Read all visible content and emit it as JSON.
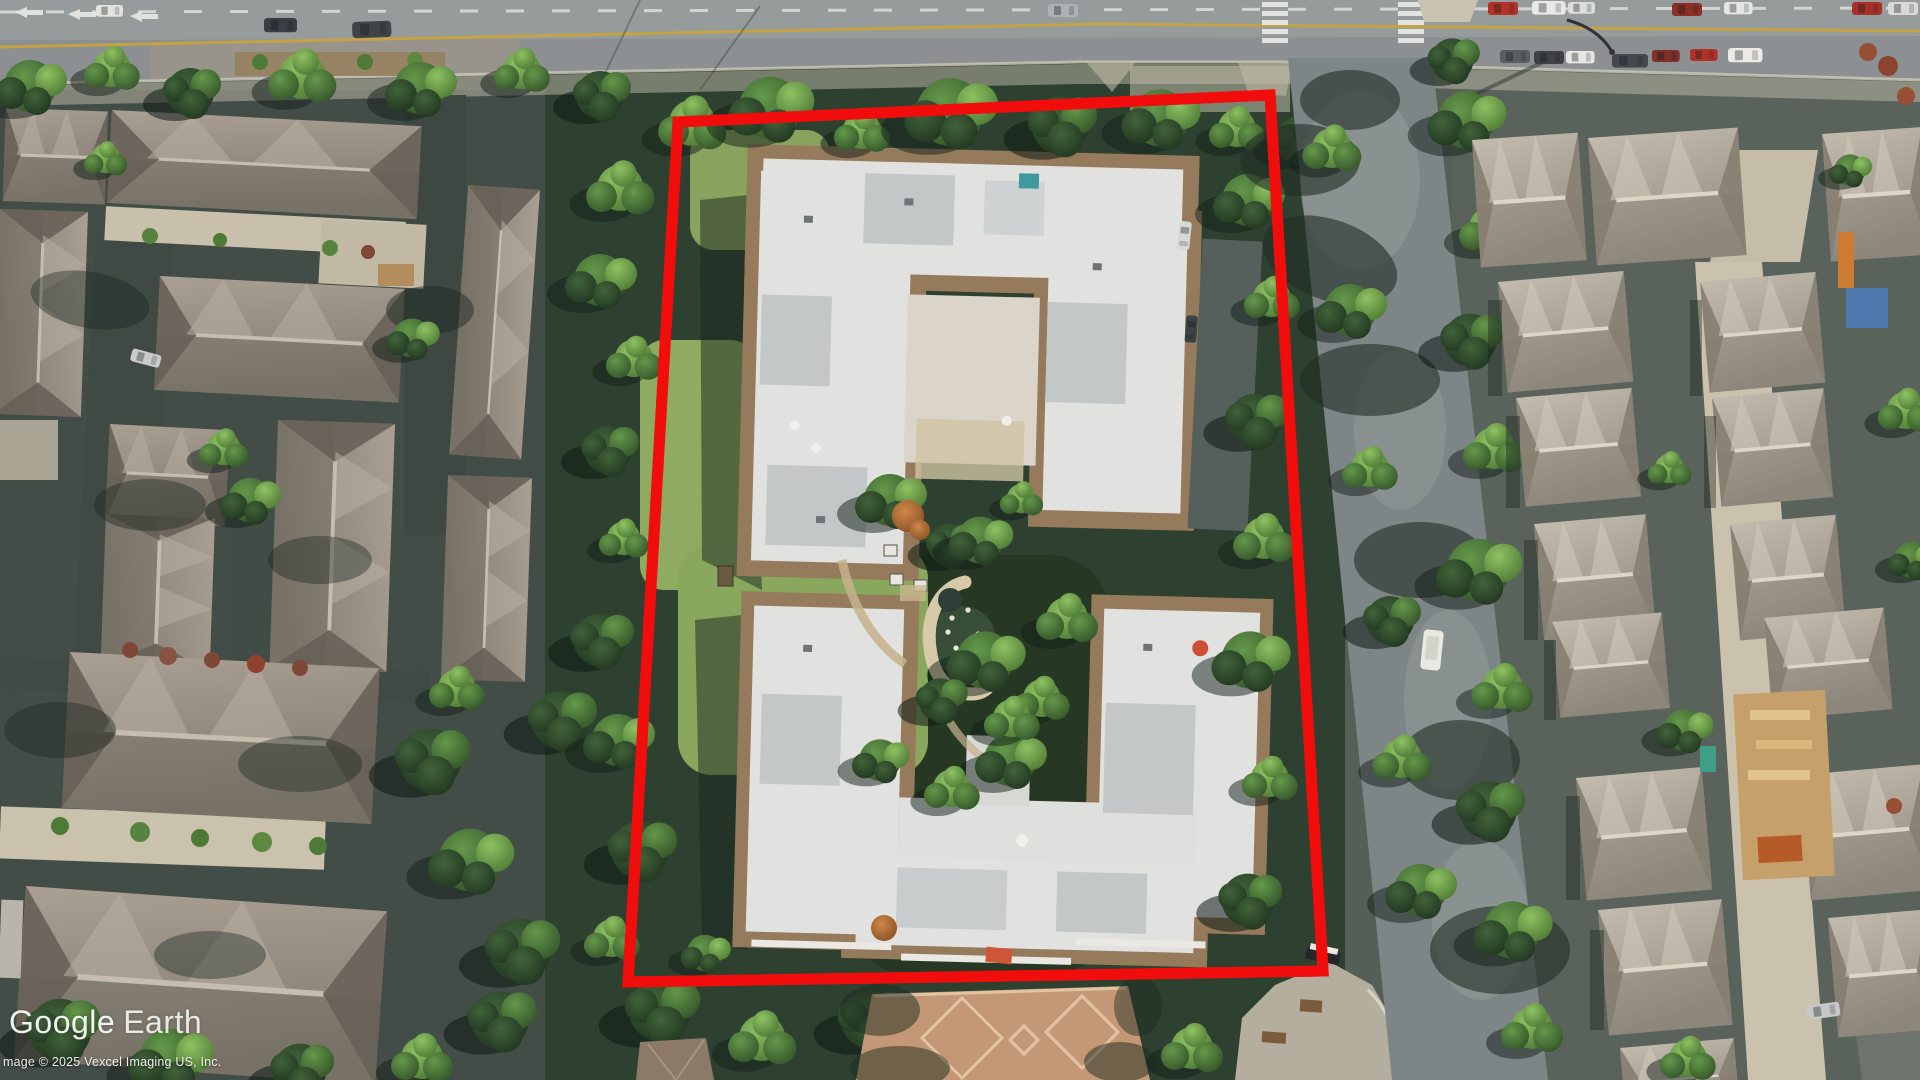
{
  "app": {
    "name_visible_in_watermark": "Google Earth"
  },
  "watermark": {
    "google": "Google",
    "earth": "Earth"
  },
  "attribution": {
    "text": "mage © 2025 Vexcel Imaging US, Inc."
  },
  "annotation": {
    "label": "property-boundary-outline",
    "color": "#f20d0d",
    "stroke_width": "11",
    "points": "678,122 1270,95 1323,971 628,982"
  },
  "palette": {
    "road": "#8d9092",
    "road_marking_yellow": "#c9a43c",
    "sidewalk": "#c2bbaa",
    "asphalt_shade": "#434d48",
    "tree_bright": "#8fc263",
    "tree_bright_edge": "#46722f",
    "tree_mid": "#64984a",
    "tree_mid_edge": "#2e4c26",
    "tree_dark": "#41633a",
    "tree_dark_edge": "#1c2f1c",
    "roof_left_light": "#a99f93",
    "roof_left_dark": "#837b70",
    "roof_right_light": "#c2bbae",
    "roof_right_dark": "#938c80",
    "condo_roof_white": "#e1e1df",
    "condo_roof_brown": "#967a5c",
    "lawn": "#8fab61",
    "plaza_brick": "#c49877",
    "concrete_lane": "#cbc2ae",
    "pond_stone": "#d7caa8"
  }
}
